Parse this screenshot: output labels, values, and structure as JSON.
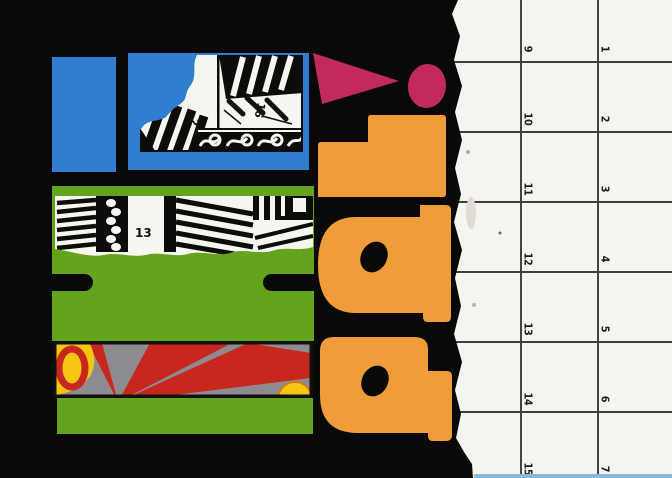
{
  "artwork": {
    "word": "pal!",
    "letters": [
      "p",
      "a",
      "l",
      "!"
    ],
    "fragment_numbers": {
      "window_number": "2",
      "balcony_number": "16",
      "facade_number": "13"
    },
    "colors": {
      "background_black": "#0a0907",
      "blue": "#2f7ed0",
      "green": "#64a41d",
      "orange": "#ee9d3a",
      "magenta": "#c22a5e",
      "ray_gray": "#8d8b8f",
      "ray_red": "#c8271d",
      "ray_yellow": "#f4c513",
      "paper_white": "#f5f4ef",
      "grid_line": "#45443c",
      "number_ink": "#1e1e1e"
    }
  },
  "calendar": {
    "left_column_days": [
      "9",
      "10",
      "11",
      "12",
      "13",
      "14",
      "15"
    ],
    "right_column_days": [
      "1",
      "2",
      "3",
      "4",
      "5",
      "6",
      "7"
    ]
  }
}
